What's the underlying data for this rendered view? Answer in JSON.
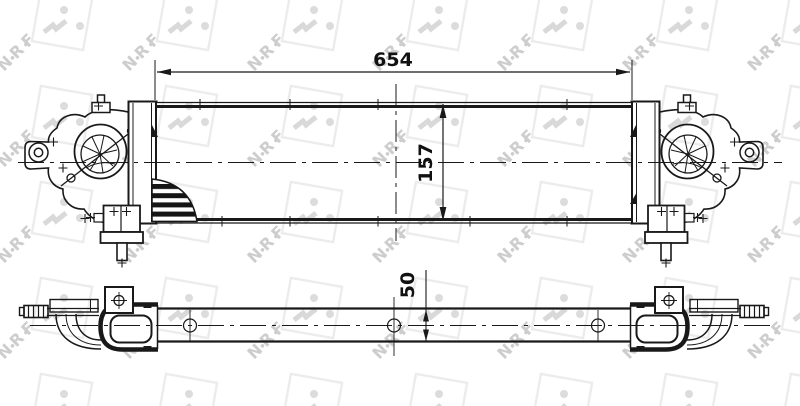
{
  "watermark": {
    "text": "NRF"
  },
  "drawing": {
    "dimensions": {
      "width": {
        "value": "654"
      },
      "height": {
        "value": "157"
      },
      "depth": {
        "value": "50"
      }
    },
    "colors": {
      "line": "#191919",
      "background": "#ffffff",
      "watermark_square": "#ececec",
      "watermark_dots": "#dcdcdc",
      "watermark_text": "#cdcdcd"
    }
  }
}
